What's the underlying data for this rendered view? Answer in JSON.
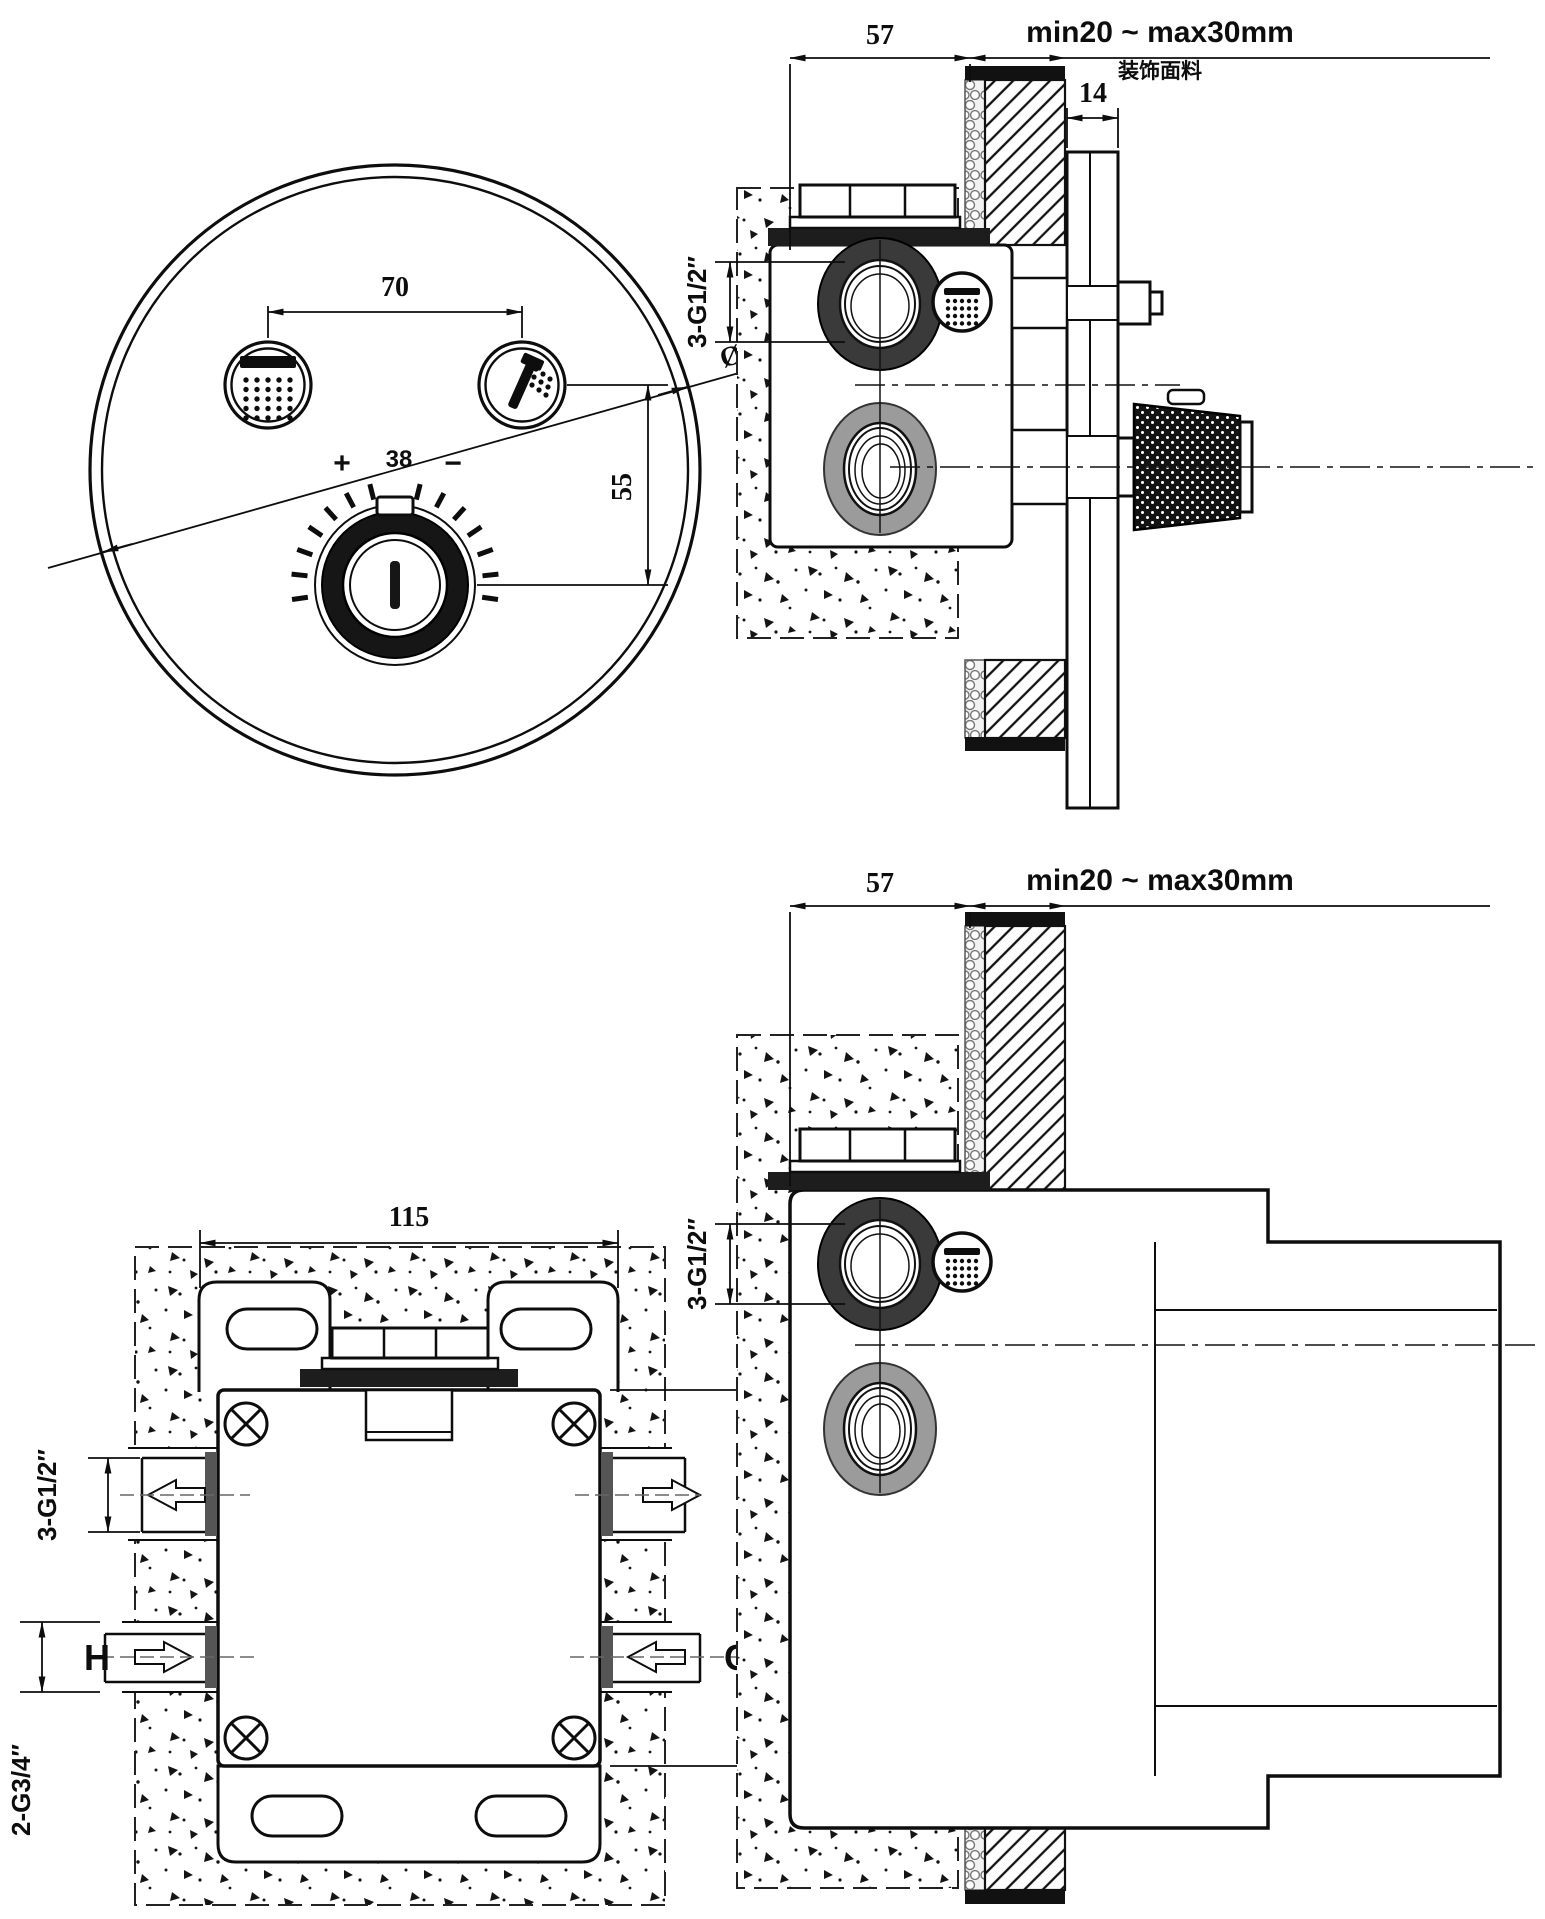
{
  "front_view": {
    "button_spacing": "70",
    "button_to_knob": "55",
    "diameter": "Ø 180",
    "temp_plus": "+",
    "temp_value": "38",
    "temp_minus": "−"
  },
  "section_view": {
    "depth": "57",
    "tile_range": "min20 ~ max30mm",
    "tile_note": "装饰面料",
    "plate_thickness": "14",
    "outlet_thread": "3-G1/2″"
  },
  "box_front_view": {
    "box_width": "115",
    "box_height": "103.5",
    "outlet_thread": "3-G1/2″",
    "inlet_thread": "2-G3/4″",
    "hot": "H",
    "cold": "C"
  },
  "box_section_view": {
    "depth": "57",
    "tile_range": "min20 ~ max30mm",
    "outlet_thread": "3-G1/2″"
  }
}
